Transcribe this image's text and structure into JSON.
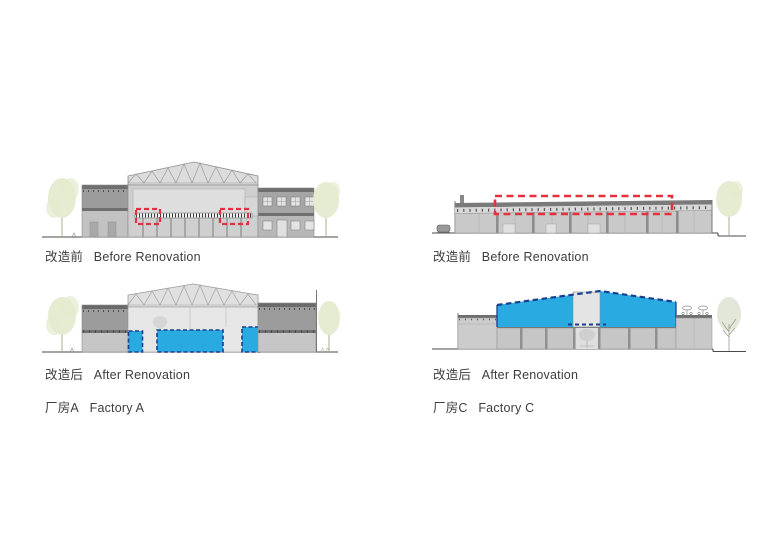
{
  "panels": {
    "factory_a": {
      "before_label_cn": "改造前",
      "before_label_en": "Before Renovation",
      "after_label_cn": "改造后",
      "after_label_en": "After Renovation",
      "name_cn": "厂房A",
      "name_en": "Factory A"
    },
    "factory_c": {
      "before_label_cn": "改造前",
      "before_label_en": "Before Renovation",
      "after_label_cn": "改造后",
      "after_label_en": "After Renovation",
      "name_cn": "厂房C",
      "name_en": "Factory C"
    }
  },
  "colors": {
    "highlight_blue": "#29ABE2",
    "highlight_blue_dash": "#1A3F8F",
    "highlight_red": "#E5303E",
    "building_gray_dark": "#6F6F6F",
    "building_gray_mid": "#9C9C9C",
    "building_gray_light": "#C6C6C6",
    "building_gray_pale": "#E3E3E3",
    "tree_green": "#E4EBCF",
    "ground_line": "#4A4A4A",
    "label_text": "#3D3D3D"
  }
}
